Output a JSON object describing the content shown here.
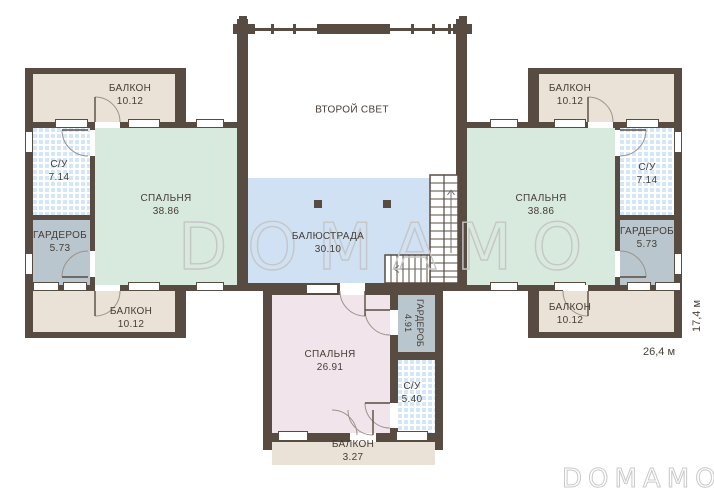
{
  "colors": {
    "wall": "#584c42",
    "balcony_fill": "#eae2d7",
    "bedroom_fill": "#d8e9de",
    "balustrade_fill": "#cfe1f3",
    "wardrobe_fill": "#bac6ce",
    "small_bedroom_fill": "#f1e5eb",
    "tile_fill": "#d3e7f8"
  },
  "watermarks": {
    "center": "DOMAMO",
    "corner": "DOMAMO"
  },
  "dimensions": {
    "width": "26,4 м",
    "height": "17,4 м"
  },
  "rooms": {
    "second_light": {
      "label": "ВТОРОЙ СВЕТ"
    },
    "balustrade": {
      "label": "БАЛЮСТРАДА",
      "area": "30.10"
    },
    "bedroom_left": {
      "label": "СПАЛЬНЯ",
      "area": "38.86"
    },
    "bedroom_right": {
      "label": "СПАЛЬНЯ",
      "area": "38.86"
    },
    "bedroom_bottom": {
      "label": "СПАЛЬНЯ",
      "area": "26.91"
    },
    "bathroom_left": {
      "label": "С/У",
      "area": "7.14"
    },
    "bathroom_right": {
      "label": "С/У",
      "area": "7.14"
    },
    "bathroom_bottom": {
      "label": "С/У",
      "area": "5.40"
    },
    "wardrobe_left": {
      "label": "ГАРДЕРОБ",
      "area": "5.73"
    },
    "wardrobe_right": {
      "label": "ГАРДЕРОБ",
      "area": "5.73"
    },
    "wardrobe_bottom": {
      "label": "ГАРДЕРОБ",
      "area": "4.91"
    },
    "balcony_top_left": {
      "label": "БАЛКОН",
      "area": "10.12"
    },
    "balcony_top_right": {
      "label": "БАЛКОН",
      "area": "10.12"
    },
    "balcony_bottom_left": {
      "label": "БАЛКОН",
      "area": "10.12"
    },
    "balcony_bottom_right": {
      "label": "БАЛКОН",
      "area": "10.12"
    },
    "balcony_bottom_center": {
      "label": "БАЛКОН",
      "area": "3.27"
    }
  }
}
